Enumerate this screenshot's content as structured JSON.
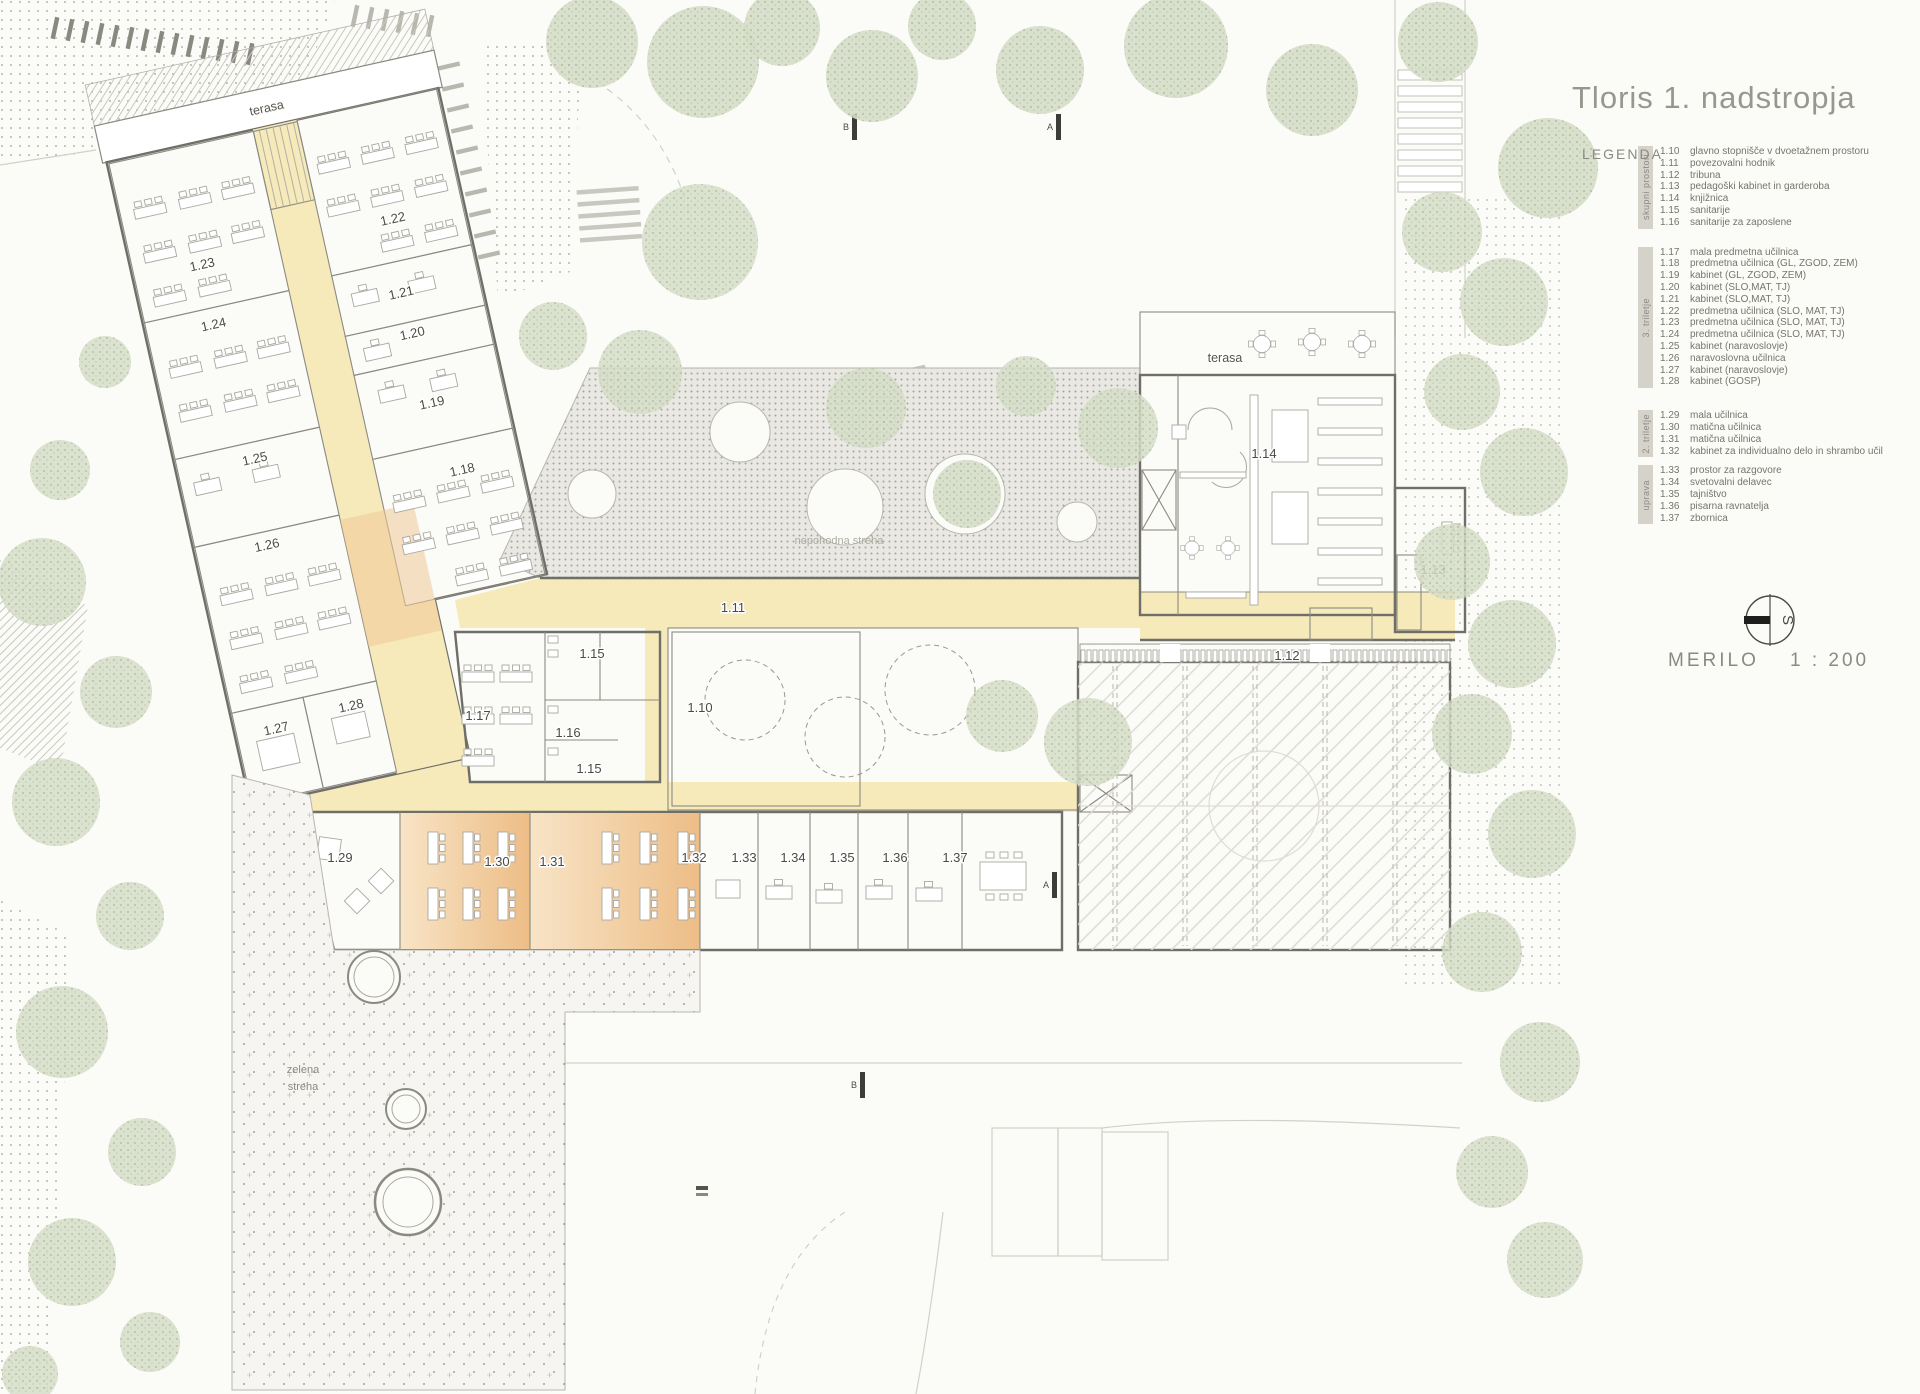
{
  "title": "Tloris 1. nadstropja",
  "legend": {
    "heading": "LEGENDA",
    "groups": [
      {
        "label": "skupni prostori"
      },
      {
        "label": "3. triletje"
      },
      {
        "label": "2. triletje"
      },
      {
        "label": "uprava"
      }
    ],
    "items": [
      {
        "num": "1.10",
        "text": "glavno stopnišče v dvoetažnem prostoru"
      },
      {
        "num": "1.11",
        "text": "povezovalni hodnik"
      },
      {
        "num": "1.12",
        "text": "tribuna"
      },
      {
        "num": "1.13",
        "text": "pedagoški kabinet in garderoba"
      },
      {
        "num": "1.14",
        "text": "knjižnica"
      },
      {
        "num": "1.15",
        "text": "sanitarije"
      },
      {
        "num": "1.16",
        "text": "sanitarije za zaposlene"
      },
      {
        "num": "1.17",
        "text": "mala predmetna učilnica"
      },
      {
        "num": "1.18",
        "text": "predmetna učilnica (GL, ZGOD, ZEM)"
      },
      {
        "num": "1.19",
        "text": "kabinet (GL, ZGOD, ZEM)"
      },
      {
        "num": "1.20",
        "text": "kabinet (SLO,MAT, TJ)"
      },
      {
        "num": "1.21",
        "text": "kabinet (SLO,MAT, TJ)"
      },
      {
        "num": "1.22",
        "text": "predmetna učilnica (SLO, MAT, TJ)"
      },
      {
        "num": "1.23",
        "text": "predmetna učilnica (SLO, MAT, TJ)"
      },
      {
        "num": "1.24",
        "text": "predmetna učilnica (SLO, MAT, TJ)"
      },
      {
        "num": "1.25",
        "text": "kabinet (naravoslovje)"
      },
      {
        "num": "1.26",
        "text": "naravoslovna učilnica"
      },
      {
        "num": "1.27",
        "text": "kabinet (naravoslovje)"
      },
      {
        "num": "1.28",
        "text": "kabinet (GOSP)"
      },
      {
        "num": "1.29",
        "text": "mala učilnica"
      },
      {
        "num": "1.30",
        "text": "matična učilnica"
      },
      {
        "num": "1.31",
        "text": "matična učilnica"
      },
      {
        "num": "1.32",
        "text": "kabinet za individualno delo in shrambo učil"
      },
      {
        "num": "1.33",
        "text": "prostor za razgovore"
      },
      {
        "num": "1.34",
        "text": "svetovalni delavec"
      },
      {
        "num": "1.35",
        "text": "tajništvo"
      },
      {
        "num": "1.36",
        "text": "pisarna ravnatelja"
      },
      {
        "num": "1.37",
        "text": "zbornica"
      }
    ]
  },
  "scale": {
    "label": "MERILO",
    "value": "1 : 200",
    "compass_letter": "S"
  },
  "plan": {
    "labels": {
      "terasa_wing": "terasa",
      "terasa_library": "terasa",
      "roof": "nepohodna streha",
      "green1": "zelena",
      "green2": "streha"
    },
    "sections": {
      "a": "A",
      "b": "B"
    },
    "rooms": {
      "r1_10": "1.10",
      "r1_11": "1.11",
      "r1_12": "1.12",
      "r1_13": "1.13",
      "r1_14": "1.14",
      "r1_15": "1.15",
      "r1_15b": "1.15",
      "r1_16": "1.16",
      "r1_17": "1.17",
      "r1_18": "1.18",
      "r1_19": "1.19",
      "r1_20": "1.20",
      "r1_21": "1.21",
      "r1_22": "1.22",
      "r1_23": "1.23",
      "r1_24": "1.24",
      "r1_25": "1.25",
      "r1_26": "1.26",
      "r1_27": "1.27",
      "r1_28": "1.28",
      "r1_29": "1.29",
      "r1_30": "1.30",
      "r1_31": "1.31",
      "r1_32": "1.32",
      "r1_33": "1.33",
      "r1_34": "1.34",
      "r1_35": "1.35",
      "r1_36": "1.36",
      "r1_37": "1.37"
    },
    "colors": {
      "classroom_orange": "#edbd86",
      "corridor_yellow": "#f6e9ba",
      "roof_grey": "#e9e8e2",
      "tree_green": "#ccd7bd"
    }
  }
}
